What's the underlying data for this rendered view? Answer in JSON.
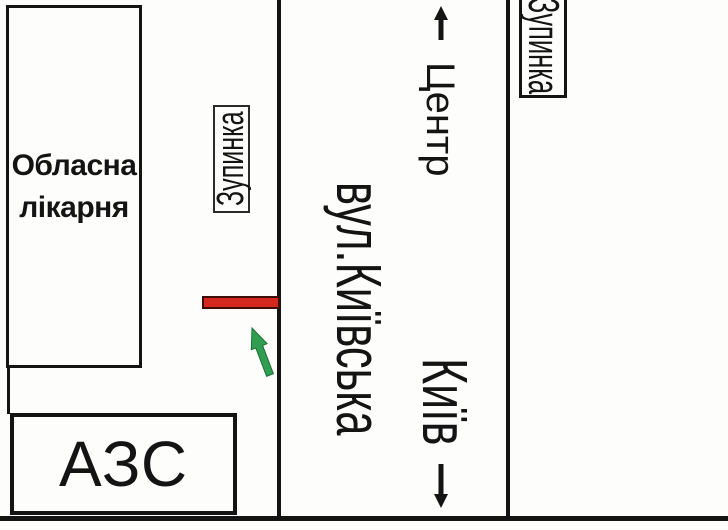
{
  "map": {
    "hospital": {
      "label": "Обласна лікарня"
    },
    "gas_station": {
      "label": "АЗС"
    },
    "street": {
      "label": "вул.Київська"
    },
    "direction_up": {
      "label": "Центр"
    },
    "direction_down": {
      "label": "Київ"
    },
    "bus_stop_left": {
      "label": "Зупинка"
    },
    "bus_stop_right": {
      "label": "Зупинка"
    },
    "colors": {
      "ink_black": "#141414",
      "billboard_red": "#d2281e",
      "billboard_border": "#3f0d08",
      "arrow_green": "#2f9e50",
      "arrow_green_dark": "#1d6e36"
    }
  }
}
